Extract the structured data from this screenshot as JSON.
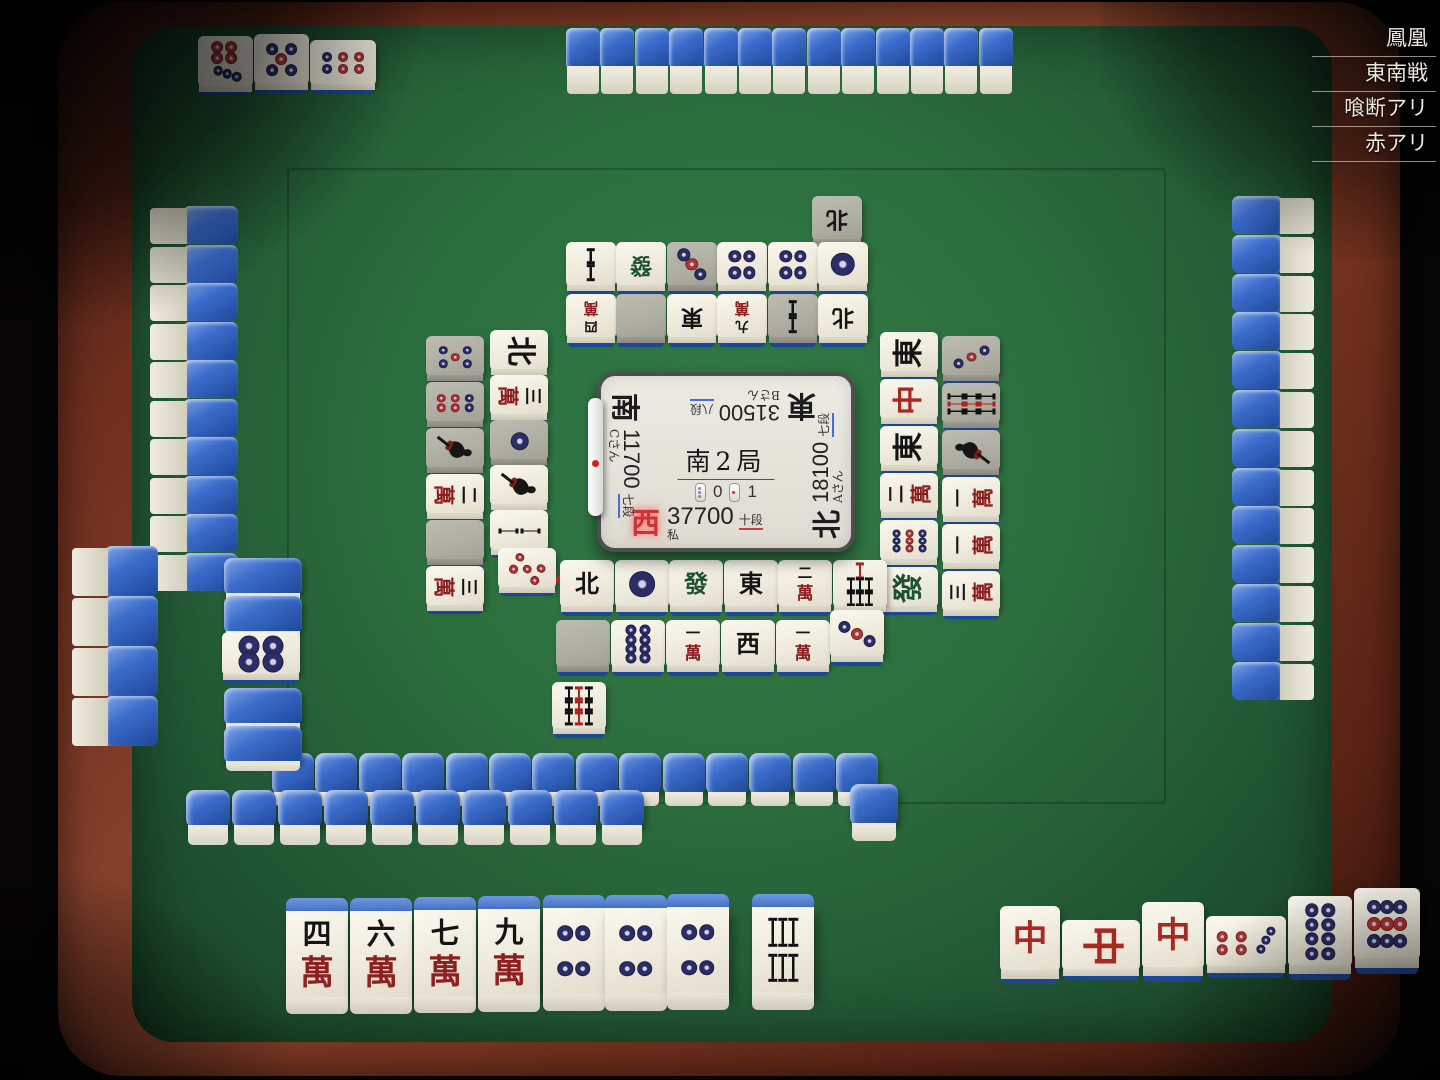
{
  "rules": [
    "鳳凰",
    "東南戦",
    "喰断アリ",
    "赤アリ"
  ],
  "center": {
    "round": "南2局",
    "counters": [
      {
        "icon": "riichi-stick-counter",
        "value": "0"
      },
      {
        "icon": "honba-stick-counter",
        "value": "1"
      }
    ],
    "players": {
      "self": {
        "wind": "西",
        "score": "37700",
        "rank": "十段",
        "name": "私",
        "rank_underline": "red"
      },
      "left": {
        "wind": "南",
        "score": "11700",
        "rank": "七段",
        "name": "Cさん",
        "rank_underline": "blue",
        "riichi": true
      },
      "top": {
        "wind": "東",
        "score": "31500",
        "rank": "八段",
        "name": "Bさん",
        "rank_underline": "blue"
      },
      "right": {
        "wind": "北",
        "score": "18100",
        "rank": "七段",
        "name": "Aさん",
        "rank_underline": "blue"
      }
    }
  },
  "game": {
    "dora_indicator": "4p",
    "self_hand": [
      "4m",
      "6m",
      "7m",
      "9m",
      "4p",
      "4p",
      "4p"
    ],
    "self_drawn": "6s",
    "self_melds": [
      [
        "C",
        "C-rotated",
        "C"
      ],
      [
        "7p-rotated",
        "8p",
        "9p"
      ]
    ],
    "top_player_meld": [
      "7p",
      "5p",
      "6p-rotated"
    ]
  },
  "tile_legend": {
    "m": "man/萬子",
    "p": "pin/筒子",
    "s": "sou/索子",
    "E": "東",
    "S": "南",
    "W": "西",
    "N": "北",
    "F": "發",
    "C": "中",
    "0p": "red five pin",
    "blank": "called-tile gap",
    "back": "face-down tile"
  },
  "tile_groups": [
    {
      "name": "opp-meld",
      "rot": 180,
      "w": 55,
      "h": 62,
      "style": "flat",
      "interact": false,
      "tiles": [
        {
          "t": "7p",
          "x": 198,
          "y": 36
        },
        {
          "t": "5p",
          "x": 254,
          "y": 34
        },
        {
          "t": "6p",
          "x": 310,
          "y": 40,
          "w": 66,
          "h": 56,
          "rot": 270
        }
      ]
    },
    {
      "name": "opp-pond",
      "rot": 180,
      "w": 50,
      "h": 55,
      "style": "flat",
      "interact": false,
      "tiles": [
        {
          "t": "N",
          "x": 812,
          "y": 196,
          "gray": true
        },
        {
          "t": "2s",
          "x": 566,
          "y": 242
        },
        {
          "t": "F",
          "x": 616,
          "y": 242
        },
        {
          "t": "3p",
          "x": 667,
          "y": 242,
          "gray": true
        },
        {
          "t": "4p",
          "x": 717,
          "y": 242
        },
        {
          "t": "4p",
          "x": 768,
          "y": 242
        },
        {
          "t": "1p",
          "x": 818,
          "y": 242
        },
        {
          "t": "4m",
          "x": 566,
          "y": 294
        },
        {
          "t": "blank",
          "x": 616,
          "y": 294,
          "gray": true
        },
        {
          "t": "E",
          "x": 667,
          "y": 294
        },
        {
          "t": "9m",
          "x": 717,
          "y": 294
        },
        {
          "t": "2s",
          "x": 768,
          "y": 294,
          "gray": true
        },
        {
          "t": "N",
          "x": 818,
          "y": 294
        }
      ]
    },
    {
      "name": "left-pond",
      "rot": 90,
      "w": 58,
      "h": 50,
      "style": "flat",
      "interact": false,
      "tiles": [
        {
          "t": "5p",
          "x": 426,
          "y": 336,
          "gray": true
        },
        {
          "t": "6p",
          "x": 426,
          "y": 382,
          "gray": true
        },
        {
          "t": "1s",
          "x": 426,
          "y": 428,
          "gray": true
        },
        {
          "t": "2m",
          "x": 426,
          "y": 474
        },
        {
          "t": "blank",
          "x": 426,
          "y": 520,
          "gray": true
        },
        {
          "t": "3m",
          "x": 426,
          "y": 566
        },
        {
          "t": "N",
          "x": 490,
          "y": 330
        },
        {
          "t": "3m",
          "x": 490,
          "y": 375
        },
        {
          "t": "1p",
          "x": 490,
          "y": 420,
          "gray": true
        },
        {
          "t": "1s",
          "x": 490,
          "y": 465
        },
        {
          "t": "2s",
          "x": 490,
          "y": 510
        },
        {
          "t": "0p",
          "x": 498,
          "y": 548,
          "rot": 118,
          "dot": true
        }
      ]
    },
    {
      "name": "right-pond",
      "rot": 270,
      "w": 58,
      "h": 50,
      "style": "flat",
      "interact": false,
      "tiles": [
        {
          "t": "E",
          "x": 880,
          "y": 332
        },
        {
          "t": "C",
          "x": 880,
          "y": 379
        },
        {
          "t": "E",
          "x": 880,
          "y": 426
        },
        {
          "t": "2m",
          "x": 880,
          "y": 473
        },
        {
          "t": "9p",
          "x": 880,
          "y": 520
        },
        {
          "t": "F",
          "x": 880,
          "y": 567
        },
        {
          "t": "3p",
          "x": 942,
          "y": 336,
          "gray": true
        },
        {
          "t": "9s",
          "x": 942,
          "y": 383,
          "gray": true
        },
        {
          "t": "1s",
          "x": 942,
          "y": 430,
          "gray": true
        },
        {
          "t": "1m",
          "x": 942,
          "y": 477
        },
        {
          "t": "1m",
          "x": 942,
          "y": 524
        },
        {
          "t": "3m",
          "x": 942,
          "y": 571
        }
      ]
    },
    {
      "name": "self-pond",
      "rot": 0,
      "w": 54,
      "h": 58,
      "style": "flat",
      "interact": false,
      "tiles": [
        {
          "t": "N",
          "x": 560,
          "y": 560
        },
        {
          "t": "1p",
          "x": 615,
          "y": 560
        },
        {
          "t": "F",
          "x": 669,
          "y": 560
        },
        {
          "t": "E",
          "x": 724,
          "y": 560
        },
        {
          "t": "2m",
          "x": 778,
          "y": 560
        },
        {
          "t": "7s",
          "x": 833,
          "y": 560
        },
        {
          "t": "blank",
          "x": 556,
          "y": 620,
          "gray": true
        },
        {
          "t": "8p",
          "x": 611,
          "y": 620
        },
        {
          "t": "1m",
          "x": 666,
          "y": 620
        },
        {
          "t": "W",
          "x": 721,
          "y": 620
        },
        {
          "t": "1m",
          "x": 776,
          "y": 620
        },
        {
          "t": "3p",
          "x": 830,
          "y": 610,
          "rot": -27
        },
        {
          "t": "9s",
          "x": 552,
          "y": 682
        }
      ]
    },
    {
      "name": "dead-wall",
      "rot": 0,
      "w": 78,
      "h": 48,
      "style": "flatback",
      "interact": false,
      "tiles": [
        {
          "t": "back",
          "x": 224,
          "y": 558
        },
        {
          "t": "back",
          "x": 224,
          "y": 596
        },
        {
          "t": "4p",
          "x": 222,
          "y": 632,
          "h": 54,
          "style": "flat"
        },
        {
          "t": "back",
          "x": 224,
          "y": 688
        },
        {
          "t": "back",
          "x": 224,
          "y": 726
        }
      ]
    },
    {
      "name": "self-hand",
      "rot": 0,
      "w": 62,
      "h": 116,
      "style": "stand",
      "interact": true,
      "tiles": [
        {
          "t": "4m",
          "x": 286,
          "y": 898
        },
        {
          "t": "6m",
          "x": 350,
          "y": 898
        },
        {
          "t": "7m",
          "x": 414,
          "y": 897
        },
        {
          "t": "9m",
          "x": 478,
          "y": 896
        },
        {
          "t": "4p",
          "x": 543,
          "y": 895
        },
        {
          "t": "4p",
          "x": 605,
          "y": 895
        },
        {
          "t": "4p",
          "x": 667,
          "y": 894
        },
        {
          "t": "6s",
          "x": 752,
          "y": 894
        }
      ]
    },
    {
      "name": "self-melds",
      "rot": 0,
      "w": 62,
      "h": 82,
      "style": "flat",
      "interact": false,
      "tiles": [
        {
          "t": "C",
          "x": 1000,
          "y": 906,
          "w": 60,
          "h": 80
        },
        {
          "t": "C",
          "x": 1062,
          "y": 920,
          "w": 78,
          "h": 62,
          "rot": 90
        },
        {
          "t": "C",
          "x": 1142,
          "y": 902
        },
        {
          "t": "7p",
          "x": 1206,
          "y": 916,
          "w": 80,
          "h": 64,
          "rot": 90
        },
        {
          "t": "8p",
          "x": 1288,
          "y": 896,
          "w": 64,
          "h": 86
        },
        {
          "t": "9p",
          "x": 1354,
          "y": 888,
          "w": 66,
          "h": 88
        }
      ]
    }
  ],
  "walls": [
    {
      "name": "wall-top",
      "type": "top",
      "x": 566,
      "y": 28,
      "count": 13,
      "dx": 34.4,
      "w": 35,
      "h": 66
    },
    {
      "name": "wall-right",
      "type": "right",
      "x": 1232,
      "y": 196,
      "count": 13,
      "dy": 38.8,
      "w": 82,
      "h": 40
    },
    {
      "name": "wall-left",
      "type": "left",
      "x": 150,
      "y": 206,
      "count": 10,
      "dy": 38.5,
      "w": 88,
      "h": 40
    },
    {
      "name": "wall-left-tail",
      "type": "left",
      "x": 72,
      "y": 546,
      "count": 4,
      "dy": 50,
      "w": 86,
      "h": 52
    },
    {
      "name": "wall-bottom-back",
      "type": "flatback",
      "x": 272,
      "y": 753,
      "count": 14,
      "dx": 43.4,
      "w": 44,
      "h": 56,
      "front": 14
    },
    {
      "name": "wall-bottom-front",
      "type": "flatback",
      "x": 186,
      "y": 790,
      "count": 10,
      "dx": 46,
      "w": 46,
      "h": 58,
      "front": 20
    },
    {
      "name": "wall-bottom-lone",
      "type": "flatback",
      "x": 850,
      "y": 784,
      "count": 1,
      "dx": 0,
      "w": 50,
      "h": 60,
      "front": 18
    }
  ],
  "colors": {
    "felt": "#2c6e3e",
    "wood": "#76341f",
    "tile_back_blue": "#2b5cb8",
    "pin_navy": "#2c2c66",
    "pin_red": "#b03434",
    "man_red": "#8e1f1f",
    "hatsu_green": "#1d5230",
    "chun_red": "#a82822",
    "accent_blue_underline": "#4a6bd8",
    "accent_red_underline": "#c34040"
  }
}
